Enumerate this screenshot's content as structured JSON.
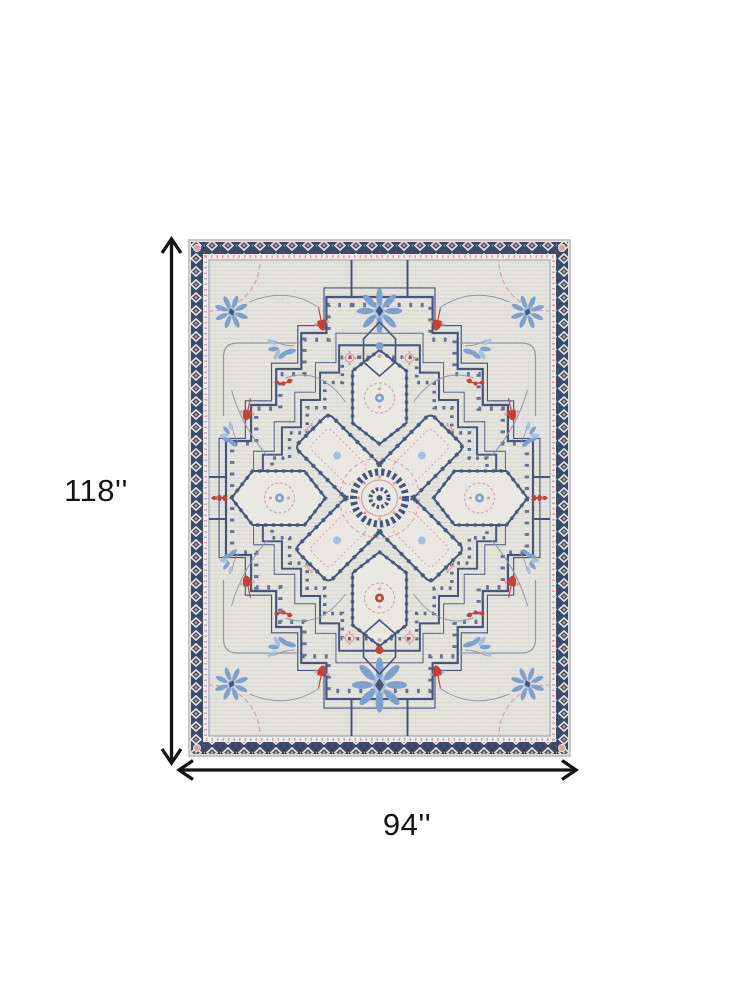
{
  "canvas": {
    "background": "#ffffff",
    "arrow_color": "#141414"
  },
  "dimensions": {
    "height_label": "118''",
    "width_label": "94''"
  },
  "rug": {
    "style": "heriz-medallion-area-rug",
    "colors": {
      "field": "#e4e2dd",
      "navy": "#46567a",
      "border_navy": "#3b4a6b",
      "blue": "#7fa0cc",
      "blue_light": "#a8c0de",
      "red": "#c2423a",
      "pink": "#d6a3a8",
      "vine": "#8e99ab",
      "cream": "#eae8e3",
      "edge": "#c9c5be"
    }
  }
}
